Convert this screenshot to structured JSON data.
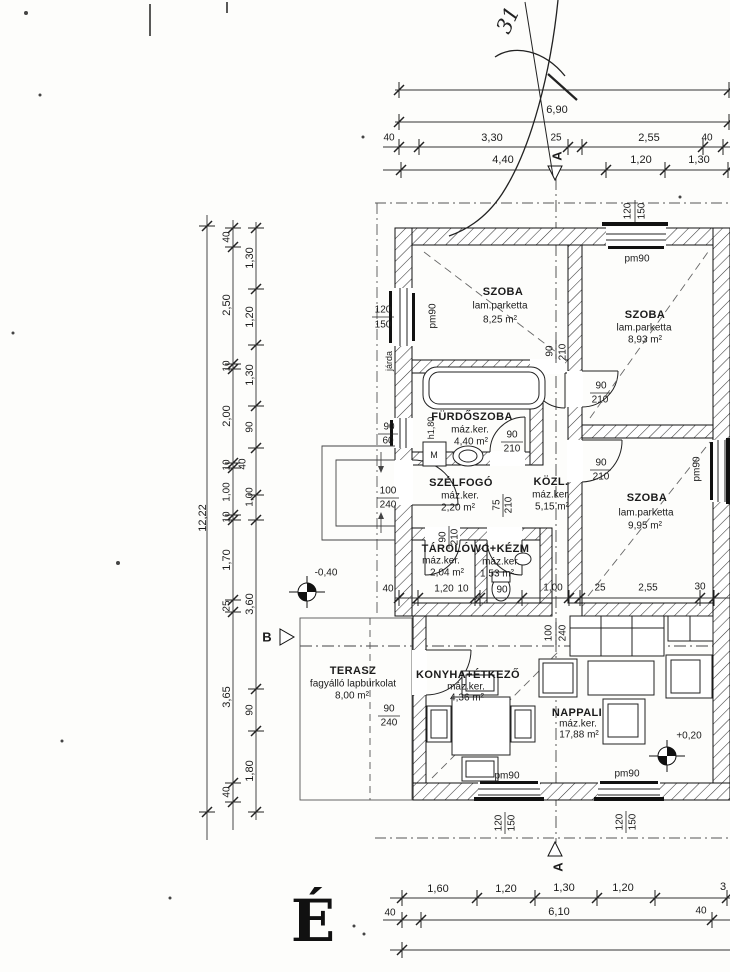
{
  "north": {
    "letter": "É"
  },
  "handwriting": {
    "note": "31"
  },
  "sections": {
    "a": "A",
    "b": "B"
  },
  "levels": {
    "terrace": "-0,40",
    "floor": "+0,20"
  },
  "rooms": {
    "szoba1": {
      "name": "SZOBA",
      "finish": "lam.parketta",
      "area": "8,25 m²"
    },
    "szoba2": {
      "name": "SZOBA",
      "finish": "lam.parketta",
      "area": "8,93 m²"
    },
    "szoba3": {
      "name": "SZOBA",
      "finish": "lam.parketta",
      "area": "9,95 m²"
    },
    "furdoszoba": {
      "name": "FÜRDŐSZOBA",
      "finish": "máz.ker.",
      "area": "4,40 m²"
    },
    "szelfogo": {
      "name": "SZÉLFOGÓ",
      "finish": "máz.ker.",
      "area": "2,20 m²"
    },
    "kozl": {
      "name": "KÖZL.",
      "finish": "máz.ker.",
      "area": "5,15 m²"
    },
    "tarolo": {
      "name": "TÁROLÓ",
      "finish": "máz.ker.",
      "area": "2,04 m²"
    },
    "wc": {
      "name": "WC+KÉZM",
      "finish": "máz.ker.",
      "area": "1,53 m²"
    },
    "terasz": {
      "name": "TERASZ",
      "finish": "fagyálló lapburkolat",
      "area": "8,00 m²"
    },
    "konyha": {
      "name": "KONYHA+ÉTKEZŐ",
      "finish": "máz.ker.",
      "area": "4,36 m²"
    },
    "nappali": {
      "name": "NAPPALI",
      "finish": "máz.ker.",
      "area": "17,88 m²"
    }
  },
  "dims": {
    "top": {
      "total": "6,90",
      "row1": [
        "40",
        "3,30",
        "25",
        "2,55",
        "40"
      ],
      "row2": [
        "4,40",
        "1,20",
        "1,30"
      ]
    },
    "bottom": {
      "row1": [
        "1,60",
        "1,20",
        "1,30",
        "1,20",
        "3"
      ],
      "row2": [
        "40",
        "6,10",
        "40"
      ]
    },
    "left": {
      "total": "12,22",
      "mid": [
        "40",
        "2,50",
        "10",
        "2,00",
        "10",
        "1,00",
        "10",
        "1,70",
        "25",
        "3,65",
        "40"
      ],
      "inner": [
        "1,30",
        "1,20",
        "1,30",
        "90",
        "1,00",
        "3,60",
        "90",
        "1,80"
      ],
      "stray": "40"
    },
    "interior": [
      "40",
      "1,20",
      "10",
      "90",
      "1,00",
      "25",
      "2,55",
      "30"
    ]
  },
  "openings": {
    "pm90": "pm90",
    "win_w": "120",
    "win_h": "150",
    "door_90": "90",
    "door_210": "210",
    "door_75": "75",
    "entry_w": "100",
    "entry_h": "240",
    "small_w": "90",
    "small_h": "60",
    "terrace_w": "90",
    "terrace_h": "240",
    "pass_w": "100",
    "pass_h": "240"
  },
  "annotations": {
    "jarda": "járda",
    "tile_height": "h1,80",
    "washer": "M"
  }
}
